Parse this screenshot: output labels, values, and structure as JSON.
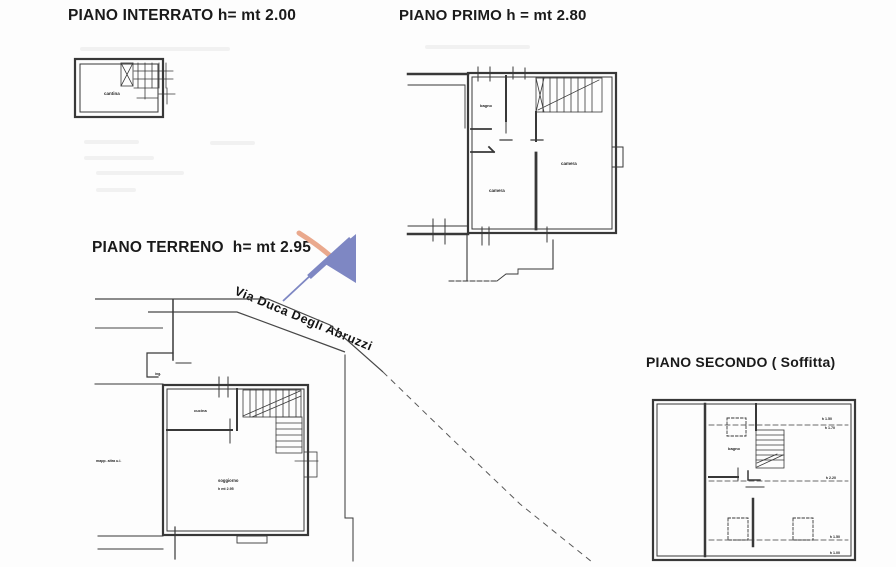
{
  "document": {
    "background": "#fdfdfd",
    "ink": "#383838",
    "type_note": "scanned cadastral floor plan sheet"
  },
  "titles": {
    "interrato": "PIANO INTERRATO h= mt 2.00",
    "primo": "PIANO PRIMO h = mt 2.80",
    "terreno": "PIANO TERRENO  h= mt 2.95",
    "secondo": "PIANO SECONDO ( Soffitta)"
  },
  "street": {
    "name": "Via Duca Degli Abruzzi"
  },
  "rooms": {
    "interrato_cantina": "cantina",
    "primo_bagno": "bagno",
    "primo_camera_sx": "camera",
    "primo_camera_dx": "camera",
    "terreno_ingresso": "ing.",
    "terreno_cucina": "cucina",
    "terreno_soggiorno": "soggiorno",
    "terreno_soggiorno_sub": "h mt 2.95",
    "terreno_altra_ui": "mapp. altra u.i.",
    "secondo_bagno": "bagno"
  },
  "height_marks": {
    "m1": "h 1.50",
    "m2": "h 1.70",
    "m3": "h 2.20",
    "m4": "h 1.50",
    "m5": "h 1.00"
  },
  "watermark": {
    "blue": "#7e87c3",
    "orange": "#eaa98d"
  }
}
